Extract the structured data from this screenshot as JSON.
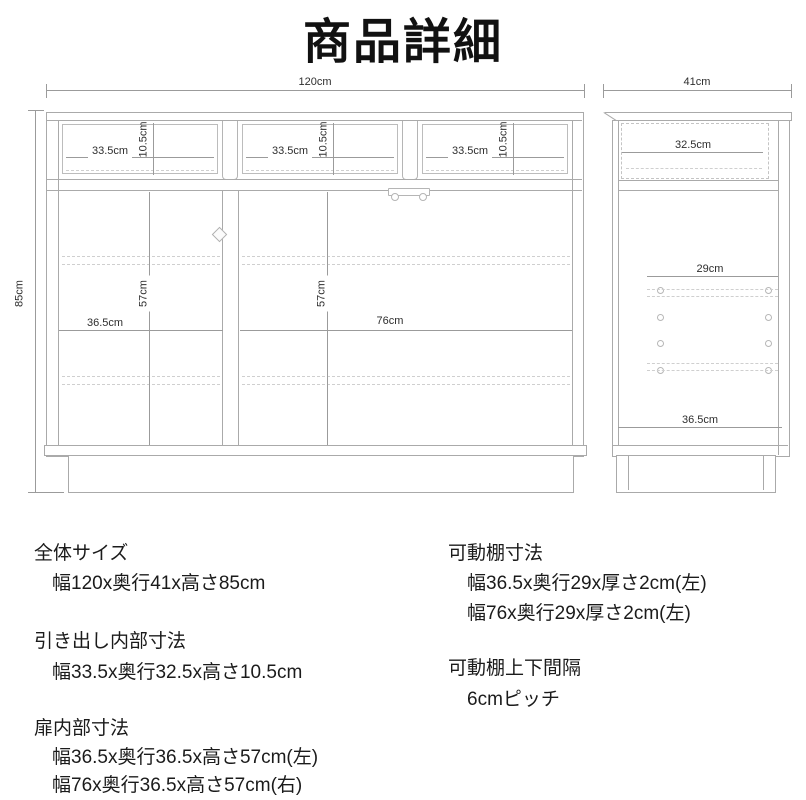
{
  "title": "商品詳細",
  "front_view": {
    "width_label": "120cm",
    "height_label": "85cm",
    "drawer_width_label": "33.5cm",
    "drawer_height_label": "10.5cm",
    "left_inner_width_label": "36.5cm",
    "left_inner_height_label": "57cm",
    "right_inner_width_label": "76cm",
    "right_inner_height_label": "57cm"
  },
  "side_view": {
    "depth_label": "41cm",
    "drawer_depth_label": "32.5cm",
    "shelf_depth_label": "29cm",
    "bottom_inner_depth_label": "36.5cm"
  },
  "specs": {
    "left": [
      {
        "heading": "全体サイズ",
        "lines": [
          "幅120x奥行41x高さ85cm"
        ]
      },
      {
        "heading": "引き出し内部寸法",
        "lines": [
          "幅33.5x奥行32.5x高さ10.5cm"
        ]
      },
      {
        "heading": "扉内部寸法",
        "lines": [
          "幅36.5x奥行36.5x高さ57cm(左)",
          "幅76x奥行36.5x高さ57cm(右)"
        ]
      }
    ],
    "right": [
      {
        "heading": "可動棚寸法",
        "lines": [
          "幅36.5x奥行29x厚さ2cm(左)",
          "幅76x奥行29x厚さ2cm(左)"
        ]
      },
      {
        "heading": "可動棚上下間隔",
        "lines": [
          "6cmピッチ"
        ]
      }
    ]
  }
}
